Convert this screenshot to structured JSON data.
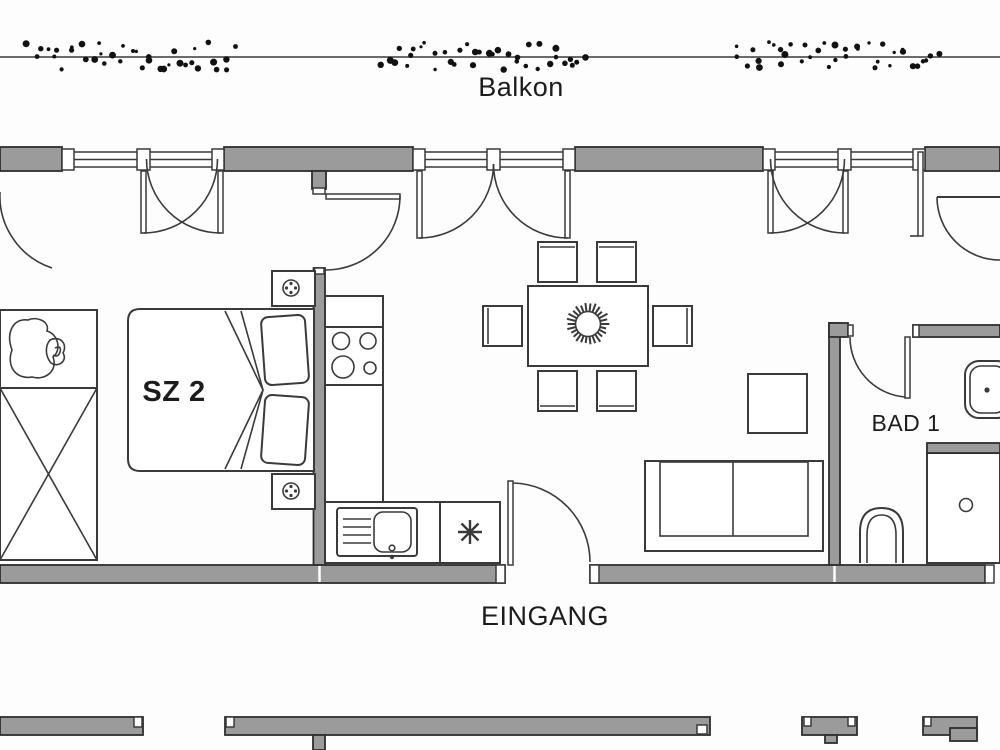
{
  "drawing": {
    "kind": "apartment floor plan",
    "labels": {
      "balcony": "Balkon",
      "bedroom_2": "SZ 2",
      "bathroom_1": "BAD 1",
      "entrance": "EINGANG"
    },
    "colors": {
      "wall_fill": "#9b9b9b",
      "wall_stroke": "#2e2e2e",
      "line": "#3a3a3a",
      "text": "#1c1c1c",
      "background": "#fdfdfd",
      "hedge_dots": "#111111"
    },
    "fixtures": [
      "hedge-shrubs",
      "balcony-french-doors",
      "double-bed",
      "pillows",
      "duvet-fold",
      "bedside-table",
      "table-lamp",
      "wardrobe",
      "potted-plant",
      "kitchen-counter",
      "cooktop-4-burners",
      "kitchen-sink",
      "faucet",
      "freezer-star",
      "dining-table",
      "dining-chairs-x6",
      "centerpiece-plant",
      "side-table",
      "sofa-2-seat",
      "washbasin",
      "toilet",
      "shower",
      "drain"
    ]
  }
}
